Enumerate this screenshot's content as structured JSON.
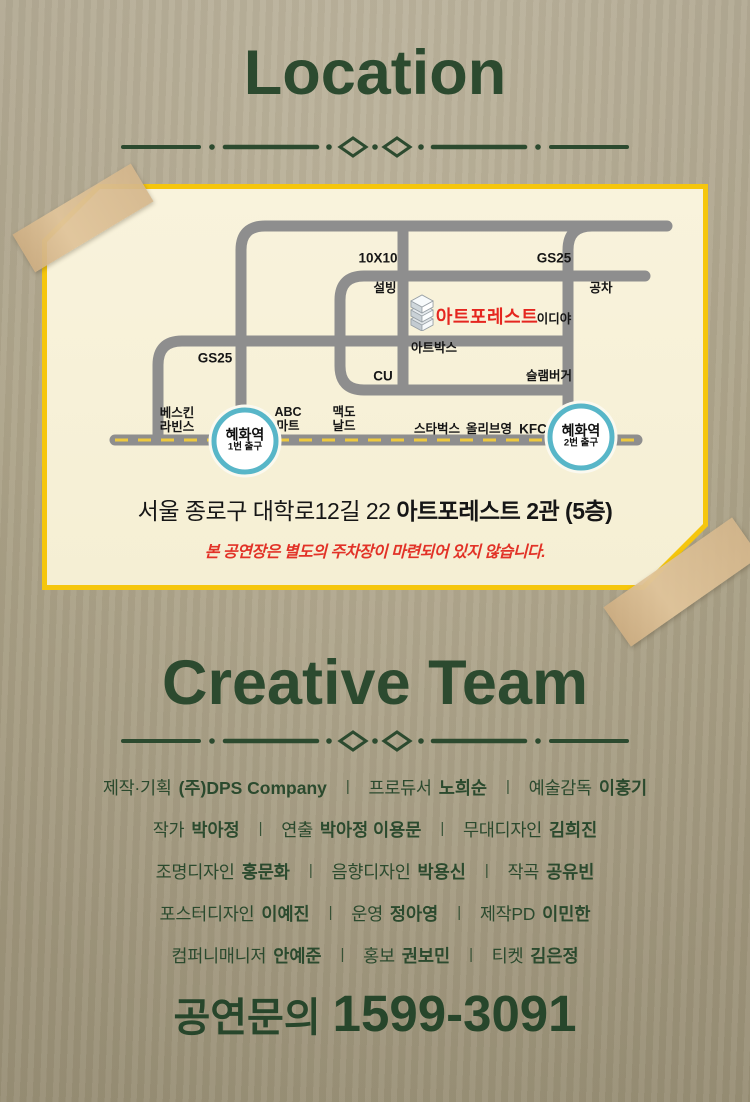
{
  "location": {
    "title": "Location",
    "map": {
      "pois": [
        {
          "text": "10X10",
          "x": 323,
          "y": 66,
          "cls": "poi-md"
        },
        {
          "text": "GS25",
          "x": 499,
          "y": 66,
          "cls": "poi-md"
        },
        {
          "text": "설빙",
          "x": 330,
          "y": 96,
          "cls": "poi-sm"
        },
        {
          "text": "공차",
          "x": 546,
          "y": 96,
          "cls": "poi-sm"
        },
        {
          "text": "아트포레스트",
          "x": 432,
          "y": 125,
          "cls": "poi-venue"
        },
        {
          "text": "이디야",
          "x": 499,
          "y": 127,
          "cls": "poi-sm"
        },
        {
          "text": "아트박스",
          "x": 379,
          "y": 156,
          "cls": "poi-sm"
        },
        {
          "text": "GS25",
          "x": 160,
          "y": 166,
          "cls": "poi-md"
        },
        {
          "text": "CU",
          "x": 328,
          "y": 184,
          "cls": "poi-md"
        },
        {
          "text": "슬램버거",
          "x": 494,
          "y": 184,
          "cls": "poi-sm"
        },
        {
          "text": "베스킨\n라빈스",
          "x": 122,
          "y": 228,
          "cls": "poi-sm"
        },
        {
          "text": "ABC\n마트",
          "x": 233,
          "y": 227,
          "cls": "poi-sm"
        },
        {
          "text": "맥도\n날드",
          "x": 289,
          "y": 227,
          "cls": "poi-sm"
        },
        {
          "text": "스타벅스",
          "x": 382,
          "y": 237,
          "cls": "poi-sm"
        },
        {
          "text": "올리브영",
          "x": 434,
          "y": 237,
          "cls": "poi-sm"
        },
        {
          "text": "KFC",
          "x": 478,
          "y": 237,
          "cls": "poi-md"
        }
      ],
      "stations": [
        {
          "name": "혜화역",
          "exit": "1번 출구",
          "x": 190,
          "y": 249
        },
        {
          "name": "혜화역",
          "exit": "2번 출구",
          "x": 526,
          "y": 245
        }
      ],
      "address_normal": "서울 종로구 대학로12길 22",
      "address_bold": "아트포레스트 2관 (5층)",
      "notice": "본 공연장은 별도의 주차장이 마련되어 있지 않습니다."
    }
  },
  "creative": {
    "title": "Creative Team",
    "separator": "|",
    "rows": [
      [
        {
          "role": "제작·기획",
          "name": "(주)DPS Company"
        },
        {
          "role": "프로듀서",
          "name": "노희순"
        },
        {
          "role": "예술감독",
          "name": "이홍기"
        }
      ],
      [
        {
          "role": "작가",
          "name": "박아정"
        },
        {
          "role": "연출",
          "name": "박아정 이용문"
        },
        {
          "role": "무대디자인",
          "name": "김희진"
        }
      ],
      [
        {
          "role": "조명디자인",
          "name": "홍문화"
        },
        {
          "role": "음향디자인",
          "name": "박용신"
        },
        {
          "role": "작곡",
          "name": "공유빈"
        }
      ],
      [
        {
          "role": "포스터디자인",
          "name": "이예진"
        },
        {
          "role": "운영",
          "name": "정아영"
        },
        {
          "role": "제작PD",
          "name": "이민한"
        }
      ],
      [
        {
          "role": "컴퍼니매니저",
          "name": "안예준"
        },
        {
          "role": "홍보",
          "name": "권보민"
        },
        {
          "role": "티켓",
          "name": "김은정"
        }
      ]
    ]
  },
  "footer": {
    "label": "공연문의",
    "phone": "1599-3091"
  },
  "colors": {
    "background": "#b3a98d",
    "title_green": "#2c4a2f",
    "map_border_yellow": "#f5c60d",
    "map_paper": "#f8f2da",
    "road_gray": "#8e8e8e",
    "road_dash_yellow": "#eec93f",
    "station_ring_teal": "#58b6c8",
    "venue_red": "#e5261f",
    "notice_red": "#e23227",
    "tape_tan": "#d7b88f"
  }
}
